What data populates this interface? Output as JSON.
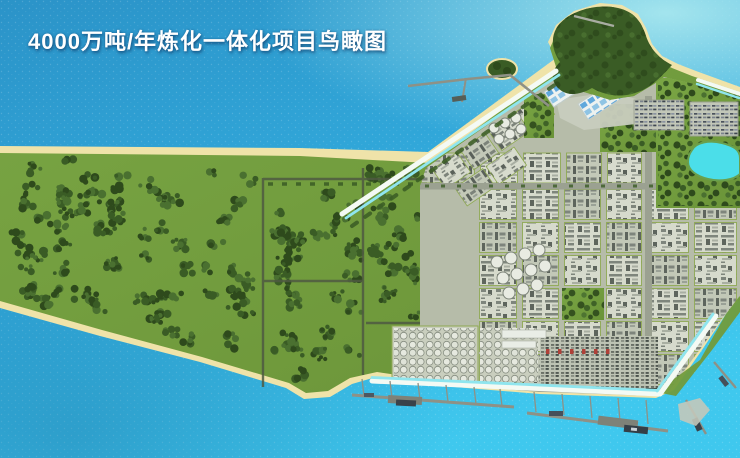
{
  "image": {
    "kind": "aerial-birdseye-rendering",
    "title": {
      "text": "4000万吨/年炼化一体化项目鸟瞰图"
    }
  },
  "colors": {
    "ocean-deep": "#2B93C8",
    "ocean-mid": "#31A8DA",
    "ocean-bright": "#3FC8EE",
    "ocean-pale": "#A9E8EF",
    "sand": "#EFE3A9",
    "grass": "#7AA644",
    "grass-dark": "#6A9338",
    "tree-dark": "#2E4A1C",
    "tree-mid": "#3A5C25",
    "tree-light": "#4A7030",
    "road-dark": "#4F5A42",
    "road-gray": "#9BA191",
    "road-light": "#B6BCA9",
    "block-light": "#D7DBCD",
    "block-mid": "#C3C9B8",
    "unit-gray": "#7C837A",
    "unit-dark": "#5A615A",
    "canal": "#8FE5EE",
    "canal-edge": "#F4FAF4",
    "pond": "#4BDEE9",
    "pier": "#8E9186",
    "ship-dark": "#39424A",
    "white-bldg": "#EDF2F0",
    "blue-roof": "#5FA8DC",
    "red-unit": "#B04038",
    "title-text": "#FFFFFF"
  }
}
